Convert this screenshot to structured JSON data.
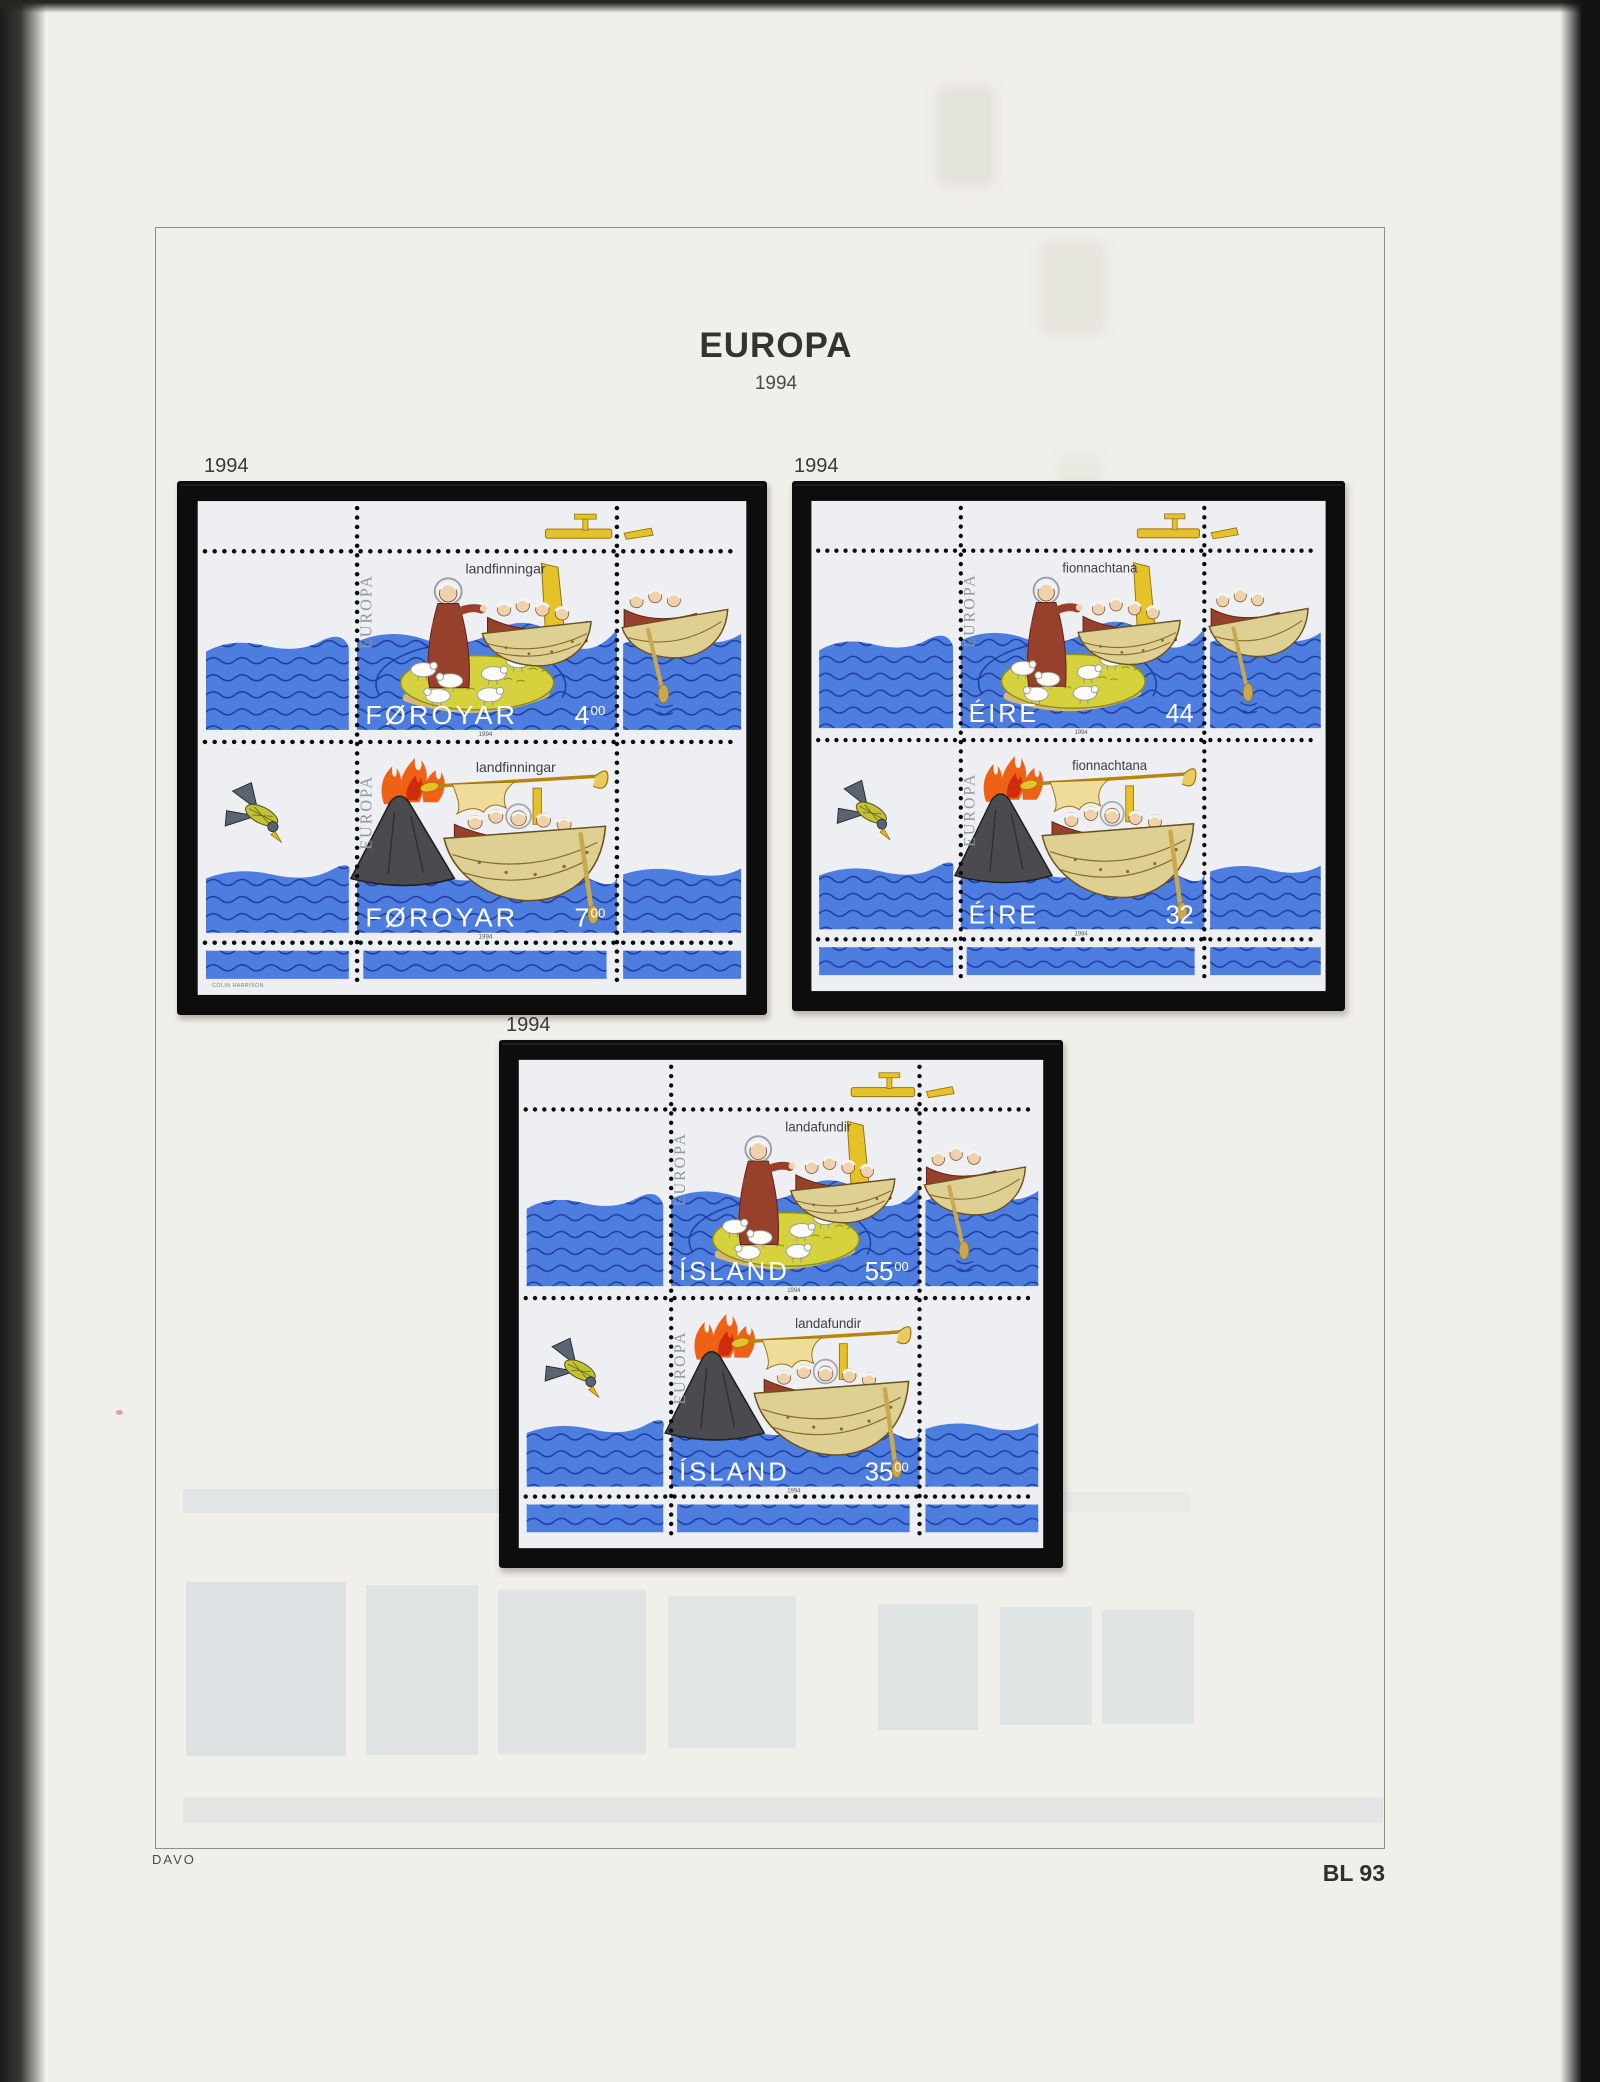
{
  "page": {
    "title": "EUROPA",
    "year": "1994",
    "publisher": "DAVO",
    "catalog_number": "BL 93",
    "colors": {
      "page_bg": "#f1efe9",
      "sheet_bg": "#edeff2",
      "frame_black": "#0d0d0d",
      "sea": "#4e7de0",
      "sea_line": "#1d3da0",
      "island": "#d6d23e",
      "island_edge": "#8e8e1a",
      "sand": "#d4b878",
      "robe": "#97402c",
      "robe_dark": "#5e2414",
      "face": "#eed2ae",
      "hair": "#f4f4f0",
      "boat": "#ddd092",
      "boat_line": "#6b4f1e",
      "gold": "#e6c22a",
      "gold_dark": "#9a7410",
      "volcano": "#4b4b4f",
      "volcano_line": "#1f1f22",
      "flame": "#ef6215",
      "flame_core": "#cf2c0c",
      "bird_wing": "#5a6470",
      "bird_body": "#c2c23a",
      "beak": "#e0b81c",
      "logo": "#8e96a2",
      "label_text": "#3e3e3e",
      "value_text": "#ffffff",
      "micro_text": "#55555a"
    }
  },
  "blocks": [
    {
      "id": "faroe",
      "year_label": "1994",
      "country": "FØROYAR",
      "issue_label": "landfinningar",
      "europa_logo": "EUROPA",
      "micro_year": "1994",
      "designer": "COLIN HARRISON",
      "stamps": [
        {
          "value": "4",
          "value_sup": "00"
        },
        {
          "value": "7",
          "value_sup": "00"
        }
      ]
    },
    {
      "id": "eire",
      "year_label": "1994",
      "country": "ÉIRE",
      "issue_label": "fionnachtana",
      "europa_logo": "EUROPA",
      "micro_year": "1994",
      "designer": "",
      "stamps": [
        {
          "value": "44",
          "value_sup": ""
        },
        {
          "value": "32",
          "value_sup": ""
        }
      ]
    },
    {
      "id": "island",
      "year_label": "1994",
      "country": "ÍSLAND",
      "issue_label": "landafundir",
      "europa_logo": "EUROPA",
      "micro_year": "1994",
      "designer": "",
      "stamps": [
        {
          "value": "55",
          "value_sup": "00"
        },
        {
          "value": "35",
          "value_sup": "00"
        }
      ]
    }
  ]
}
